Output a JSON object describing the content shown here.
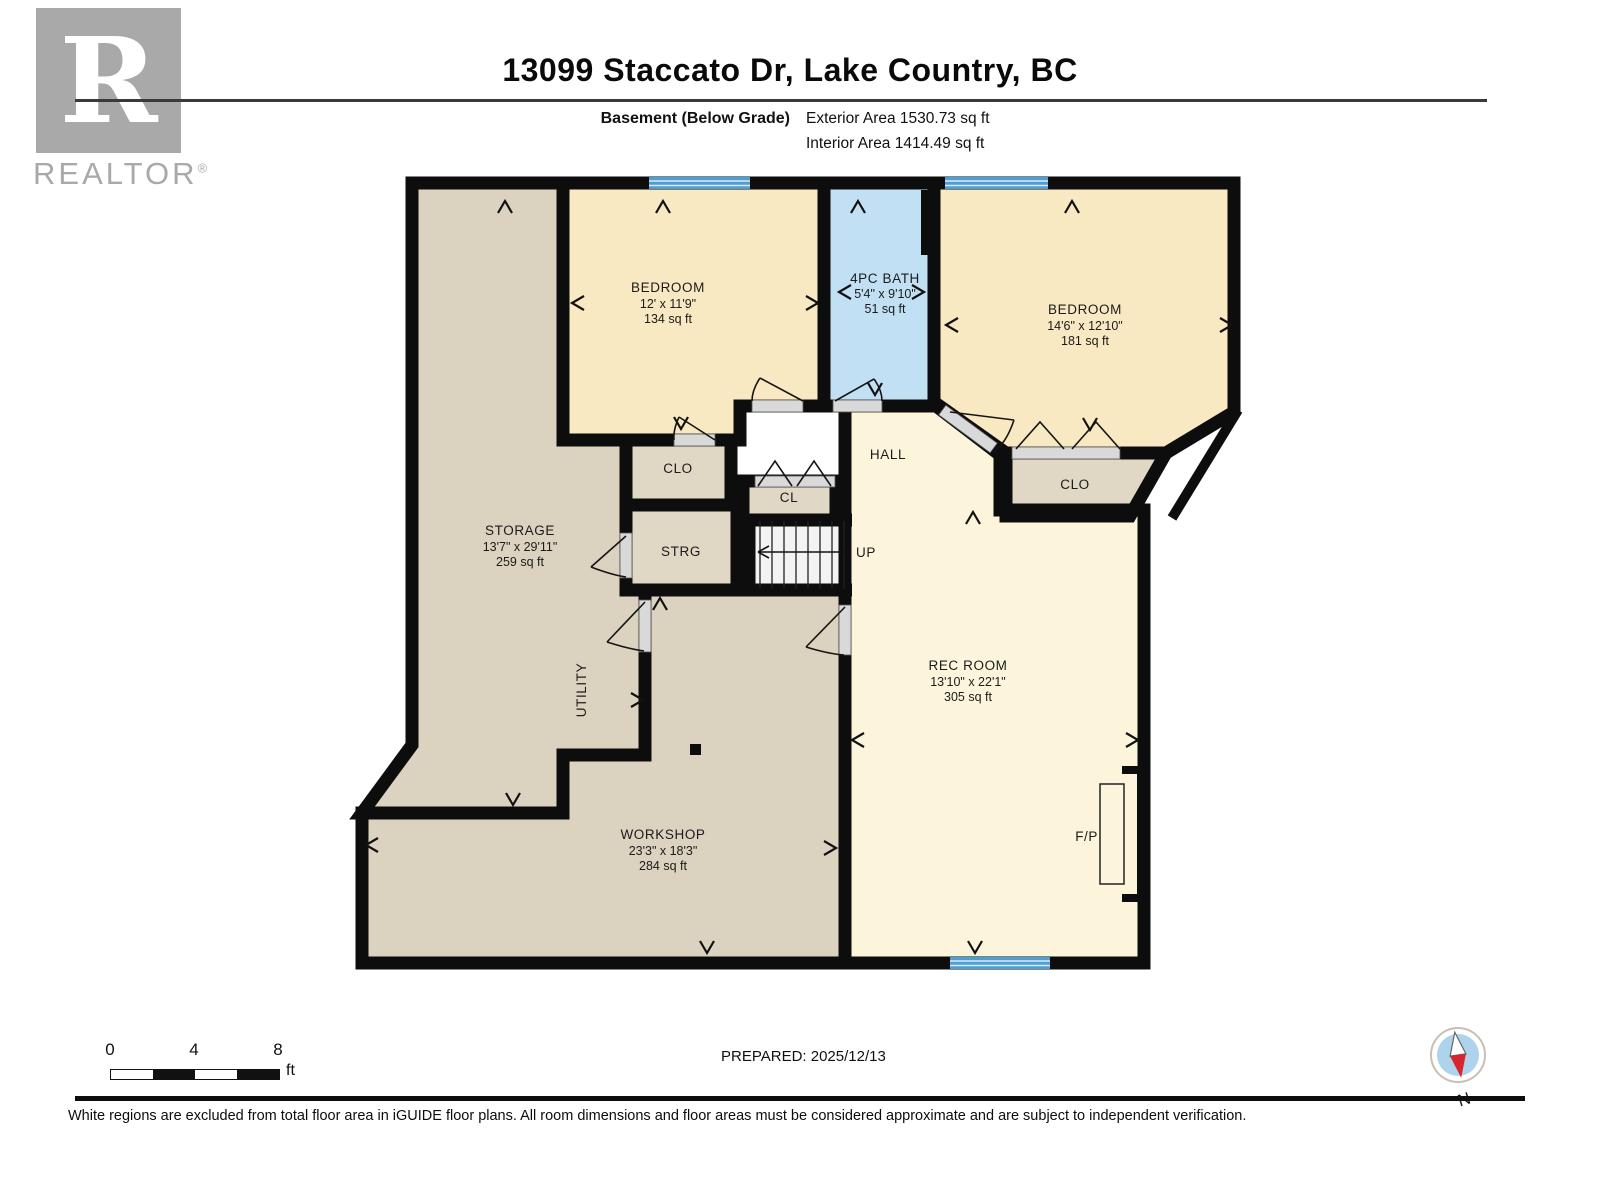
{
  "header": {
    "title": "13099 Staccato Dr, Lake Country, BC",
    "floor_label": "Basement (Below Grade)",
    "exterior_area": "Exterior Area 1530.73 sq ft",
    "interior_area": "Interior Area 1414.49 sq ft"
  },
  "logo": {
    "letter": "R",
    "brand": "REALTOR",
    "registered": "®"
  },
  "rooms": {
    "bedroom1": {
      "name": "BEDROOM",
      "dims": "12' x 11'9\"",
      "area": "134 sq ft"
    },
    "bath": {
      "name": "4PC BATH",
      "dims": "5'4\" x 9'10\"",
      "area": "51 sq ft"
    },
    "bedroom2": {
      "name": "BEDROOM",
      "dims": "14'6\" x 12'10\"",
      "area": "181 sq ft"
    },
    "storage": {
      "name": "STORAGE",
      "dims": "13'7\" x 29'11\"",
      "area": "259 sq ft"
    },
    "rec_room": {
      "name": "REC ROOM",
      "dims": "13'10\" x 22'1\"",
      "area": "305 sq ft"
    },
    "workshop": {
      "name": "WORKSHOP",
      "dims": "23'3\" x 18'3\"",
      "area": "284 sq ft"
    },
    "utility": {
      "name": "UTILITY"
    },
    "hall": {
      "name": "HALL"
    },
    "clo_left": {
      "name": "CLO"
    },
    "cl": {
      "name": "CL"
    },
    "strg": {
      "name": "STRG"
    },
    "clo_right": {
      "name": "CLO"
    },
    "fireplace": {
      "name": "F/P"
    },
    "stairs": {
      "name": "UP"
    }
  },
  "scale_bar": {
    "t0": "0",
    "t4": "4",
    "t8": "8",
    "unit": "ft"
  },
  "compass": {
    "label": "N"
  },
  "footer": {
    "prepared": "PREPARED: 2025/12/13",
    "disclaimer": "White regions are excluded from total floor area in iGUIDE floor plans. All room dimensions and floor areas must be considered approximate and are subject to independent verification."
  },
  "colors": {
    "wall": "#0d0d0d",
    "room_cream": "#F9E9C2",
    "hall_cream": "#FCF5DC",
    "bath_blue": "#C2E0F4",
    "window_blue": "#4E9ED2",
    "storage_tan": "#DCD2C0",
    "closet_tan": "#E0D7C5",
    "logo_gray": "#A9A9A9",
    "compass_red": "#D8242C"
  }
}
